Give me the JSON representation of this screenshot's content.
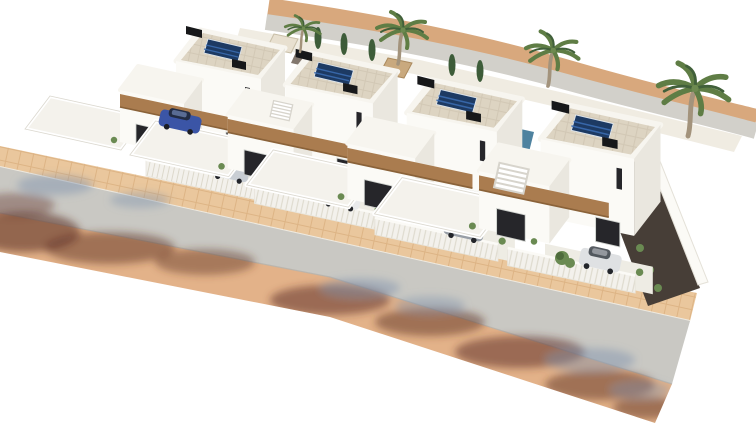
{
  "scene": {
    "type": "3d-architectural-aerial-render",
    "subject": "Aerial 3D render of a row of four modern white two-storey villas with rooftop solar panels, wooden fascia accents, walled driveways with parked cars, palm and cypress trees, a dark gravel garden bed, and a street with sidewalk pavers and tree shadows in front",
    "villa_count": 4,
    "colors": {
      "background": "#ffffff",
      "wall": "#fbfaf6",
      "wall_shade": "#eae7df",
      "parapet": "#f7f5ef",
      "roof_tile": "#ddd4c2",
      "roof_grout": "#ccc2ad",
      "solar_panel": "#1d3a63",
      "solar_cell": "#3a6bb0",
      "wood_beam": "#aa7c4f",
      "window": "#26262a",
      "sidewalk": "#eac79d",
      "paver_line": "#d9ad7d",
      "road": "#c9c8c3",
      "dirt": "#e3b289",
      "shadow_warm": "#5e3026",
      "shadow_cool": "#7d90ad",
      "palm_leaf": "#5f7d45",
      "palm_dark": "#41603a",
      "palm_trunk": "#a3937c",
      "bush": "#6a8a52",
      "gravel": "#473e37",
      "pool": "#2f6c8e",
      "fence": "#f3f1ec",
      "path": "#d2d0ca",
      "path_edge": "#d8a87d",
      "ac_unit": "#17181a",
      "curb": "#efeae0",
      "yard": "#f4f2ec",
      "driveway": "#eeece4",
      "garden_band": "#ece7db"
    },
    "villas": [
      {
        "id": 1,
        "dx": 130,
        "dy": 30,
        "scale": 1.0,
        "car_color": "#c9ced4"
      },
      {
        "id": 2,
        "dx": 238,
        "dy": 53,
        "scale": 1.03,
        "car_color": "#e9eaec"
      },
      {
        "id": 3,
        "dx": 358,
        "dy": 80,
        "scale": 1.06,
        "car_color": "#989ea6"
      },
      {
        "id": 4,
        "dx": 490,
        "dy": 105,
        "scale": 1.1,
        "car_color": "#dfe1e3"
      }
    ],
    "extra_car": {
      "villa": 1,
      "color": "#3b55a6",
      "x": 180,
      "y": 122
    },
    "palms": [
      {
        "x": 300,
        "y": 52,
        "scale": 0.7
      },
      {
        "x": 398,
        "y": 64,
        "scale": 1.0
      },
      {
        "x": 548,
        "y": 86,
        "scale": 1.05
      },
      {
        "x": 688,
        "y": 136,
        "scale": 1.4
      }
    ]
  }
}
